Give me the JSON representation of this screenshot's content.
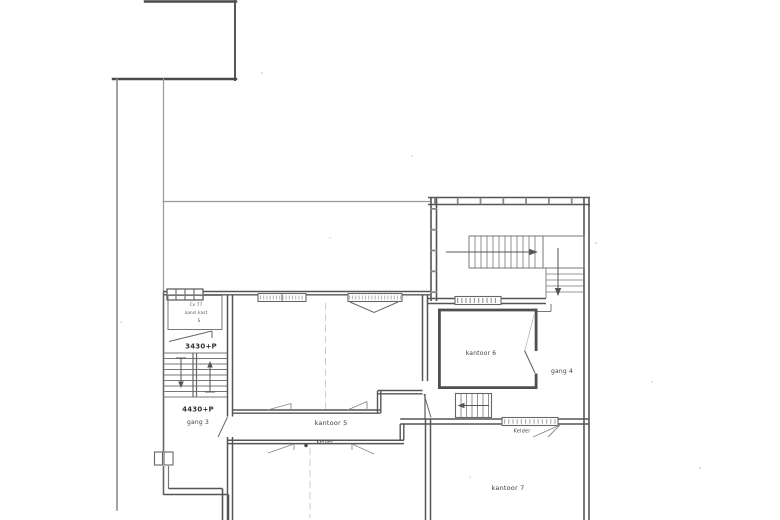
{
  "document": {
    "type": "scanned architectural floor plan (souterrain/kelder level)",
    "colors": {
      "paper": "#ffffff",
      "ink_dark": "#4d4d4d",
      "ink_medium": "#6e6e6e",
      "ink_light": "#9a9a9a",
      "ink_faint": "#cfcfcf"
    }
  },
  "labels": {
    "closet_line1": "Cv 77",
    "closet_line2": "aansl.kast",
    "closet_line3": "S",
    "level_upper": "3430+P",
    "level_lower": "4430+P",
    "gang3": "gang 3",
    "kantoor5": "kantoor 5",
    "kelder_center": "Kelder",
    "kantoor6": "kantoor 6",
    "gang4": "gang 4",
    "kelder_right": "Kelder",
    "kantoor7": "kantoor 7"
  }
}
